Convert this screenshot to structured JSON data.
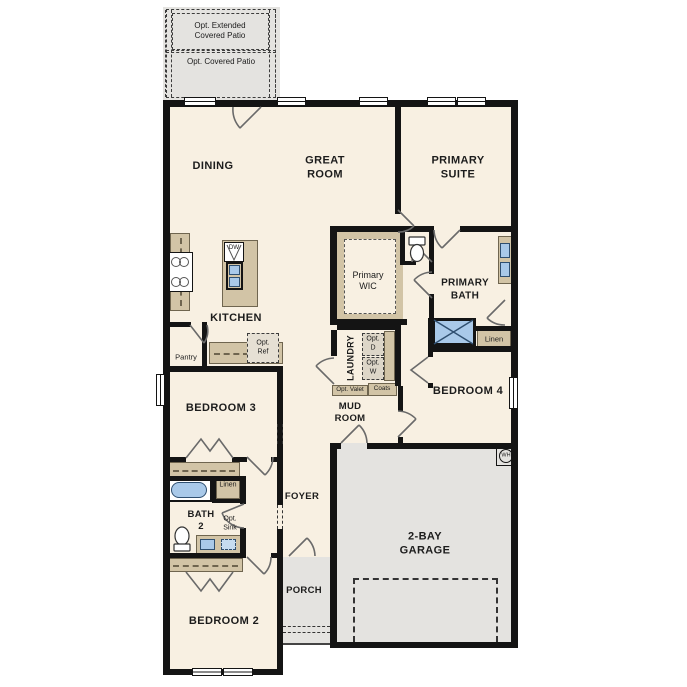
{
  "colors": {
    "floor": "#f8f0e2",
    "concrete": "#e4e3e0",
    "cabinet": "#d2c4a6",
    "fixture_blue": "#a9c9e9",
    "wall": "#141414"
  },
  "patio": {
    "extended_label": "Opt. Extended\nCovered Patio",
    "covered_label": "Opt. Covered Patio"
  },
  "rooms": {
    "dining": "DINING",
    "great_room": "GREAT\nROOM",
    "primary_suite": "PRIMARY\nSUITE",
    "kitchen": "KITCHEN",
    "primary_wic": "Primary\nWIC",
    "primary_bath": "PRIMARY\nBATH",
    "laundry": "LAUNDRY",
    "mud_room": "MUD\nROOM",
    "bedroom_3": "BEDROOM 3",
    "bedroom_4": "BEDROOM 4",
    "bath_2": "BATH\n2",
    "bedroom_2": "BEDROOM 2",
    "foyer": "FOYER",
    "porch": "PORCH",
    "garage": "2-BAY\nGARAGE",
    "pantry": "Pantry"
  },
  "features": {
    "linen_bath": "Linen",
    "linen_hall": "Linen",
    "coats": "Coats",
    "opt_valet": "Opt. Valet",
    "opt_d": "Opt.\nD",
    "opt_w": "Opt.\nW",
    "opt_ref": "Opt.\nRef",
    "opt_sink": "Opt.\nSink",
    "dw": "DW",
    "wh": "WH"
  }
}
